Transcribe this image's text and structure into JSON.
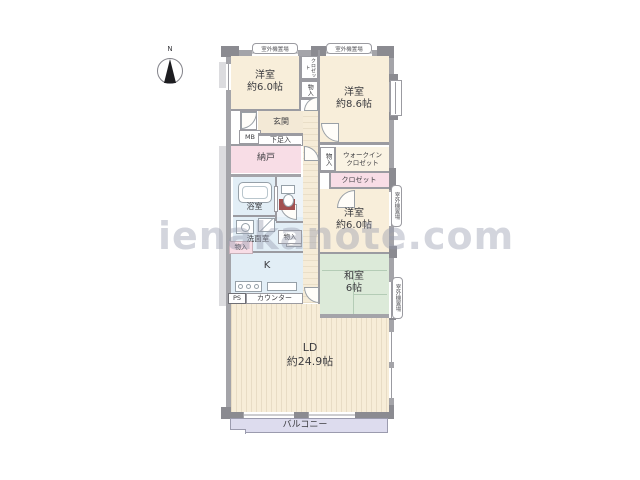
{
  "watermark": {
    "text": "ienakanote.com"
  },
  "compass": {
    "north": "N"
  },
  "rooms": {
    "bedroom1": {
      "name": "洋室",
      "size": "約6.0帖"
    },
    "bedroom2": {
      "name": "洋室",
      "size": "約8.6帖"
    },
    "bedroom3": {
      "name": "洋室",
      "size": "約6.0帖"
    },
    "tatami": {
      "name": "和室",
      "size": "6帖"
    },
    "living": {
      "name": "LD",
      "size": "約24.9帖"
    }
  },
  "labels": {
    "outdoor_unit": "室外機置場",
    "genkan": "玄関",
    "mb": "MB",
    "geta": "下足入",
    "nando": "納戸",
    "monoire": "物入",
    "closet_tiny": "クロゼット",
    "wic_line1": "ウォークイン",
    "wic_line2": "クロゼット",
    "closet": "クロゼット",
    "bath": "浴室",
    "senmen": "洗面室",
    "kitchen": "K",
    "ps": "PS",
    "counter": "カウンター",
    "balcony": "バルコニー"
  },
  "colors": {
    "western_room": "#f8eeda",
    "tatami_room": "#dcead9",
    "wet_area": "#e2eef6",
    "storage_pink": "#f8dde6",
    "balcony": "#dddcee",
    "wall": "#a4a4a9",
    "watermark": "#9aa0b2"
  }
}
